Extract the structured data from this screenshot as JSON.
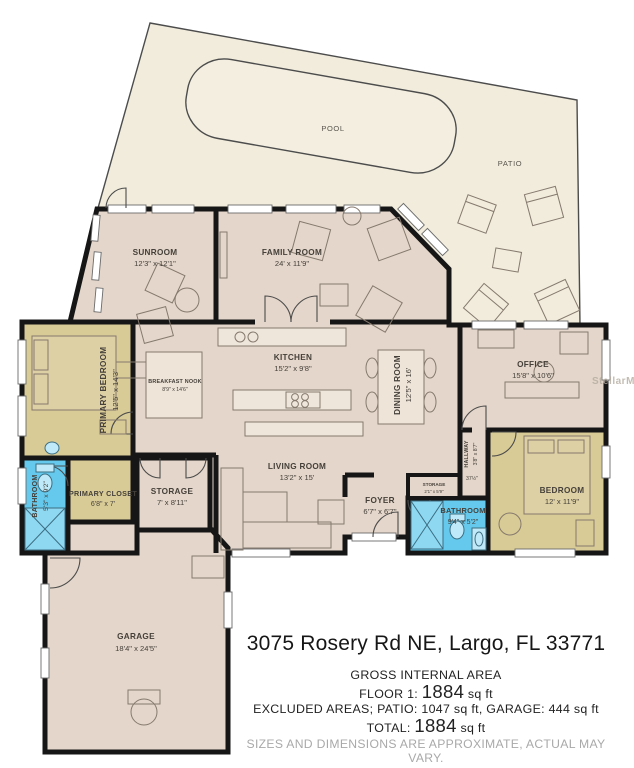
{
  "colors": {
    "wall": "#161616",
    "room": "#e4d6ca",
    "bedroom": "#d8cb96",
    "bathroom": "#64c9ec",
    "patio": "#f1ecdc",
    "furniture_line": "#85796d"
  },
  "outdoor": {
    "pool_label": "POOL",
    "patio_label": "PATIO"
  },
  "watermark": "StellarMLS",
  "rooms": [
    {
      "name": "SUNROOM",
      "dims": "12'3\" x 12'1\""
    },
    {
      "name": "FAMILY ROOM",
      "dims": "24' x 11'9\""
    },
    {
      "name": "KITCHEN",
      "dims": "15'2\" x 9'8\""
    },
    {
      "name": "DINING ROOM",
      "dims": "12'5\" x 16'"
    },
    {
      "name": "OFFICE",
      "dims": "15'8\" x 10'6\""
    },
    {
      "name": "PRIMARY BEDROOM",
      "dims": "12'5\" x 14'3\""
    },
    {
      "name": "BREAKFAST NOOK",
      "dims": "8'9\" x 14'6\""
    },
    {
      "name": "LIVING ROOM",
      "dims": "13'2\" x 15'"
    },
    {
      "name": "PRIMARY CLOSET",
      "dims": "6'8\" x 7'"
    },
    {
      "name": "BATHROOM",
      "dims": "5'3\" x 9'2\""
    },
    {
      "name": "STORAGE",
      "dims": "7' x 8'11\""
    },
    {
      "name": "HALLWAY",
      "dims": "3'8\" x 8'7\"",
      "note": "37½\""
    },
    {
      "name": "STORAGE",
      "dims": "2'1\" x 5'9\""
    },
    {
      "name": "FOYER",
      "dims": "6'7\" x 6'7\""
    },
    {
      "name": "BATHROOM",
      "dims": "9'4\" x 5'2\""
    },
    {
      "name": "BEDROOM",
      "dims": "12' x 11'9\""
    },
    {
      "name": "GARAGE",
      "dims": "18'4\" x 24'5\""
    }
  ],
  "footer": {
    "address": "3075 Rosery Rd NE, Largo, FL 33771",
    "area_title": "GROSS INTERNAL AREA",
    "floor_label": "FLOOR 1:",
    "floor_value": "1884",
    "floor_unit": "sq ft",
    "excluded": "EXCLUDED AREAS; PATIO: 1047 sq ft, GARAGE: 444 sq ft",
    "total_label": "TOTAL:",
    "total_value": "1884",
    "total_unit": "sq ft",
    "disclaimer": "SIZES AND DIMENSIONS ARE APPROXIMATE, ACTUAL MAY VARY."
  }
}
